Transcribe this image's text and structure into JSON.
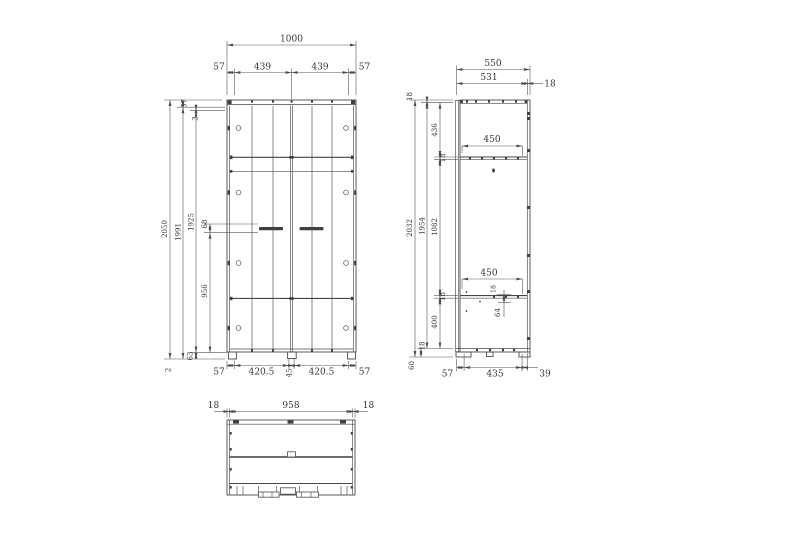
{
  "meta": {
    "drawing_type": "furniture technical drawing (wardrobe, three views)",
    "colors": {
      "background": "#ffffff",
      "line": "#4a4a4a",
      "text": "#353535"
    }
  },
  "front": {
    "top": {
      "total": "1000",
      "s1": "57",
      "s2": "439",
      "s3": "439",
      "s4": "57"
    },
    "left": {
      "h_total": "2050",
      "h_inner": "1991",
      "h_door": "1925",
      "t57": "57",
      "t3": "3",
      "m68": "68",
      "m956": "956",
      "b63": "63",
      "b2": "2"
    },
    "bottom": {
      "s1": "57",
      "s2": "420.5",
      "mid": "45",
      "s3": "420.5",
      "s4": "57"
    }
  },
  "side": {
    "top": {
      "total": "550",
      "inner": "531",
      "back": "18"
    },
    "left": {
      "t18": "18",
      "h_total": "2032",
      "h_inner": "1954",
      "s436": "436",
      "s18a": "18",
      "s1082": "1082",
      "s18b": "18",
      "s400": "400",
      "b18": "18",
      "b60": "60"
    },
    "inner": {
      "d450a": "450",
      "d450b": "450",
      "t18": "18",
      "v64": "64"
    },
    "bottom": {
      "s1": "57",
      "s2": "435",
      "s3": "39"
    }
  },
  "plan": {
    "top": {
      "s1": "18",
      "s2": "958",
      "s3": "18"
    }
  }
}
